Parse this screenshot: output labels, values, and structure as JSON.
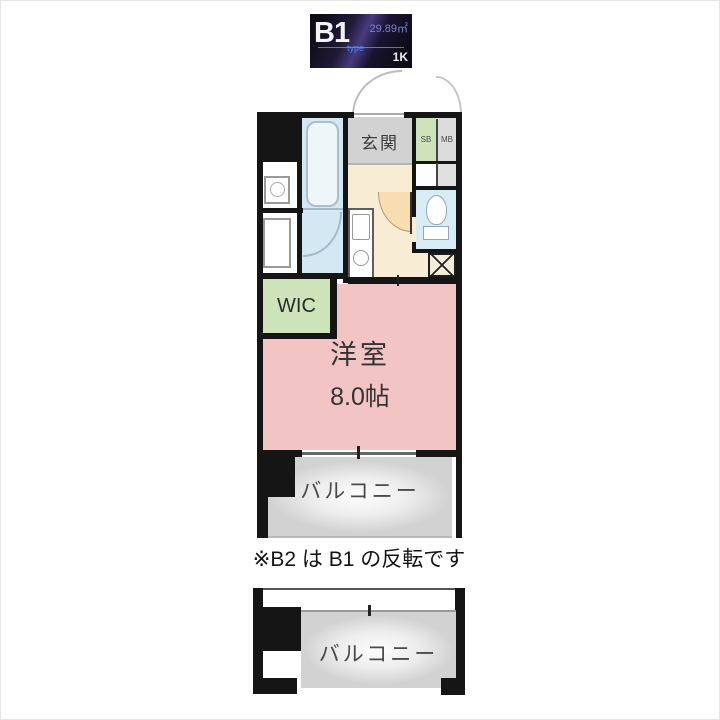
{
  "badge": {
    "unit_name": "B1",
    "unit_suffix": "type",
    "area": "29.89㎡",
    "floor_plan_type": "1K"
  },
  "floor_plan": {
    "entrance_label": "玄関",
    "shoe_box_label": "SB",
    "meter_box_label": "MB",
    "walk_in_closet_label": "WIC",
    "main_room_label": "洋室",
    "main_room_size": "8.0帖",
    "balcony_label": "バルコニー",
    "note": "※B2 は B1 の反転です",
    "lower_unit_balcony_label": "バルコニー"
  },
  "colors": {
    "wall": "#151515",
    "room_pink": "#f2c4c4",
    "closet_green": "#cde4bb",
    "entrance_gray": "#d2d2d2",
    "hall_cream": "#f8ecd4",
    "door_arc_peach": "#f8ddb0",
    "bath_blue": "#d4e8f3",
    "toilet_blue": "#d8ecf5",
    "balcony_gray": "#d3d3d3",
    "badge_bg": "#14101e",
    "badge_accent_blue": "#4d7de8",
    "badge_area_purple": "#7d83d6"
  }
}
